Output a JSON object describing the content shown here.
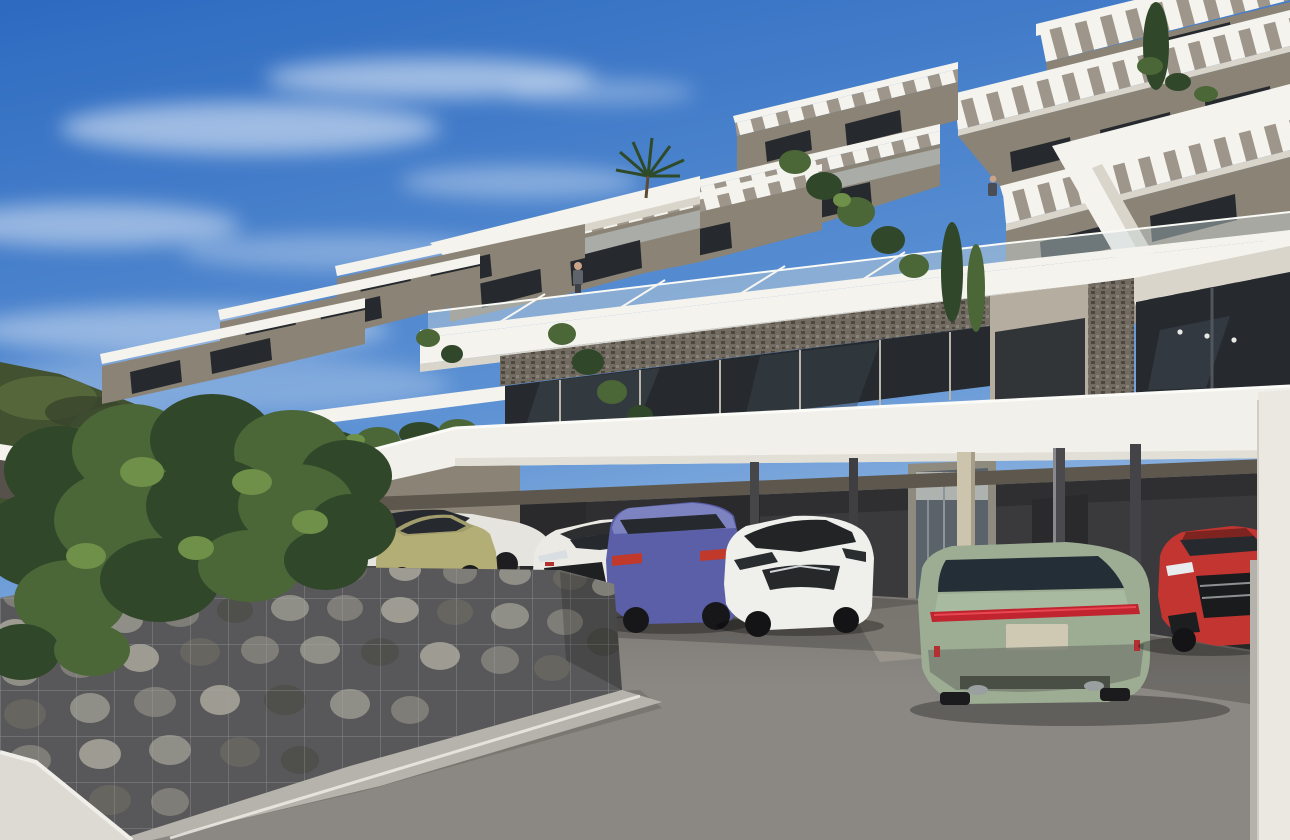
{
  "meta": {
    "description": "3D architectural rendering of a modern hillside apartment complex with stepped white terraces and slatted pergola roofs, a ground-level carport with seven parked cars, a gabion stone wall and leafy tree in the foreground, a green hillside to the left and a blue sky with wispy clouds",
    "width_px": 1290,
    "height_px": 840,
    "render_style": "photorealistic CGI exterior visualization"
  },
  "palette": {
    "sky_top": "#2d6ac0",
    "sky_mid": "#5d92d4",
    "sky_low": "#b6cfe9",
    "cloud": "#ffffff",
    "hill_dark": "#42512f",
    "hill_mid": "#5a6c3e",
    "slab_white": "#f4f3ee",
    "slab_shade": "#d9d5cb",
    "slat_base": "#9e968a",
    "wall_light": "#b5aea0",
    "wall_mid": "#8b8476",
    "wall_dark": "#6b6458",
    "soffit": "#5e574d",
    "awning_dark": "#56514a",
    "glass_dark": "#262a2e",
    "glass_mid": "#3c454e",
    "glass_blue": "#232e36",
    "balustrade": "#c7d4d8",
    "stone_base": "#716b62",
    "stone_dot1": "#4d473f",
    "stone_dot2": "#8a8379",
    "canopy_white": "#f1f0ea",
    "carport_wall": "#3a3a3c",
    "carport_top": "#2f2f32",
    "door_dark": "#2a2a2d",
    "lobby_frame": "#8e8a7e",
    "lobby_glass": "#5a626a",
    "lobby_light": "#aeb3b0",
    "column_dark": "#464649",
    "column_beige": "#cdc4ae",
    "pavement": "#8b8883",
    "pavement_far": "#75726d",
    "pavement_sun": "#9b978f",
    "curb": "#b6b3ac",
    "pillar_white": "#eae8e1",
    "gabion_bg": "#58585a",
    "mesh": "#a3a8aa",
    "stone1": "#7e7d77",
    "stone2": "#908f87",
    "stone3": "#666560",
    "stone4": "#9d9b92",
    "stone5": "#4f4f4b",
    "plant_dark": "#31472a",
    "plant_mid": "#4b6637",
    "plant_light": "#6e9048",
    "skin": "#c9a489",
    "shirt_dark": "#5f646b"
  },
  "scene": {
    "sky": {
      "label": "blue sky with wispy cirrus clouds"
    },
    "hillside": {
      "label": "green forested hillside behind building, left"
    },
    "building": {
      "label": "white stepped apartment terraces cascading up to the right",
      "features": [
        "slatted pergola canopies",
        "glass balustrades",
        "stone-clad accent walls",
        "floor-to-ceiling tinted glazing",
        "hanging terrace plants",
        "cypress trees",
        "palm tree"
      ]
    },
    "carport": {
      "label": "ground-level carport with long white canopy",
      "columns": 6,
      "doors": 3,
      "lobby": "glazed entrance door"
    },
    "people": [
      {
        "label": "resident standing at lower terrace balustrade"
      },
      {
        "label": "resident standing on upper balcony"
      }
    ],
    "cars": [
      {
        "label": "white sedan",
        "color": "#e6e4de",
        "view": "side, partly hidden"
      },
      {
        "label": "olive-green hatchback",
        "color": "#b3ad76",
        "view": "three-quarter front"
      },
      {
        "label": "white sports sedan",
        "color": "#eceae4",
        "view": "three-quarter front"
      },
      {
        "label": "blue SUV",
        "color": "#5a5fa8",
        "view": "rear three-quarter"
      },
      {
        "label": "white compact hatchback",
        "color": "#eff0ec",
        "view": "three-quarter front"
      },
      {
        "label": "sage-green sports sedan",
        "color": "#9cad93",
        "view": "rear"
      },
      {
        "label": "red sports coupe",
        "color": "#c23531",
        "view": "front, cropped by pillar"
      }
    ],
    "gabion_wall": {
      "label": "wire-mesh gabion wall filled with grey river stones"
    },
    "tree": {
      "label": "leafy green tree overhanging the gabion wall"
    },
    "pavement": {
      "label": "grey paved driveway with canopy and car shadows"
    }
  }
}
